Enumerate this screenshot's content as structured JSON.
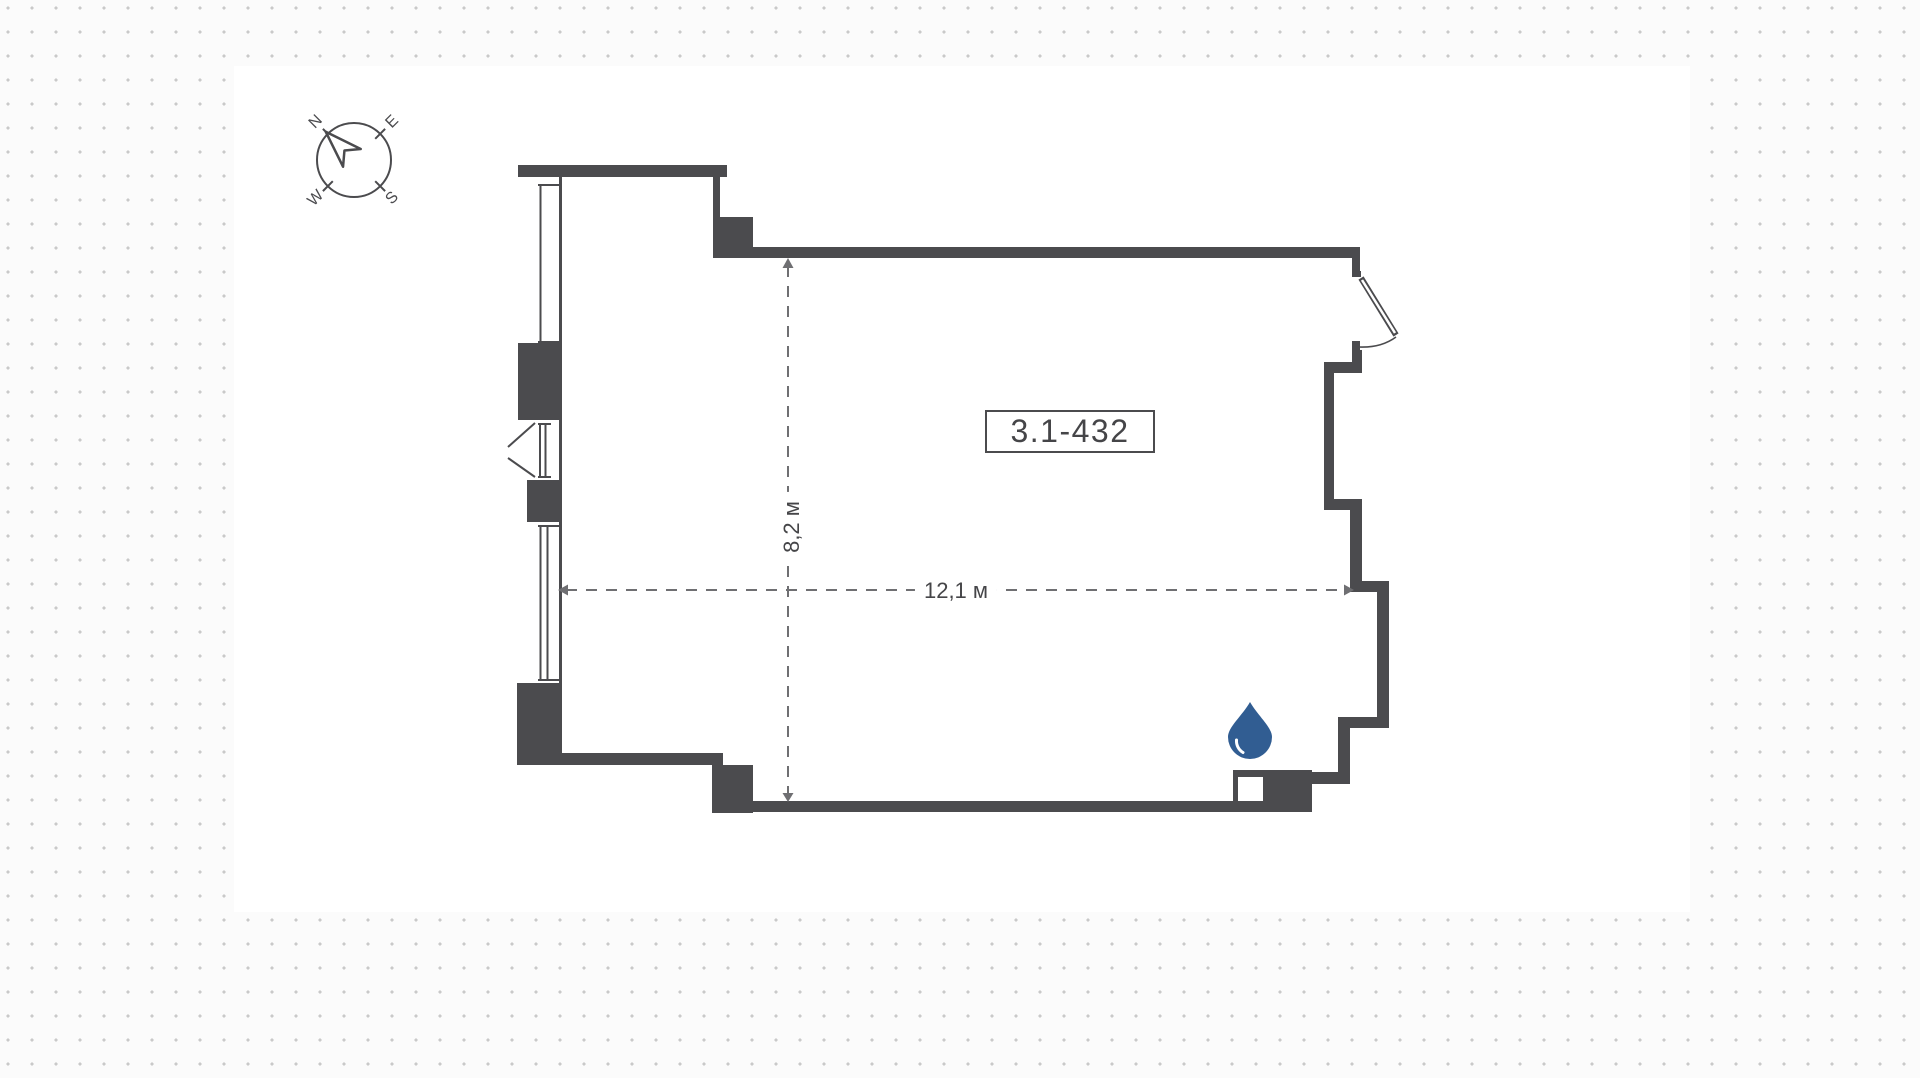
{
  "room": {
    "number": "3.1-432",
    "width_label": "12,1 м",
    "depth_label": "8,2 м"
  },
  "compass": {
    "north": "N",
    "east": "E",
    "south": "S",
    "west": "W"
  },
  "icons": {
    "water_drop_icon": "💧",
    "north_arrow_icon": "➤"
  },
  "colors": {
    "background": "#fbfbfb",
    "surface": "#ffffff",
    "dots": "#c9c9c9",
    "wall": "#4b4b4e",
    "dim_line": "#6f6f72",
    "text": "#454548",
    "accent_drop": "#315d92"
  }
}
